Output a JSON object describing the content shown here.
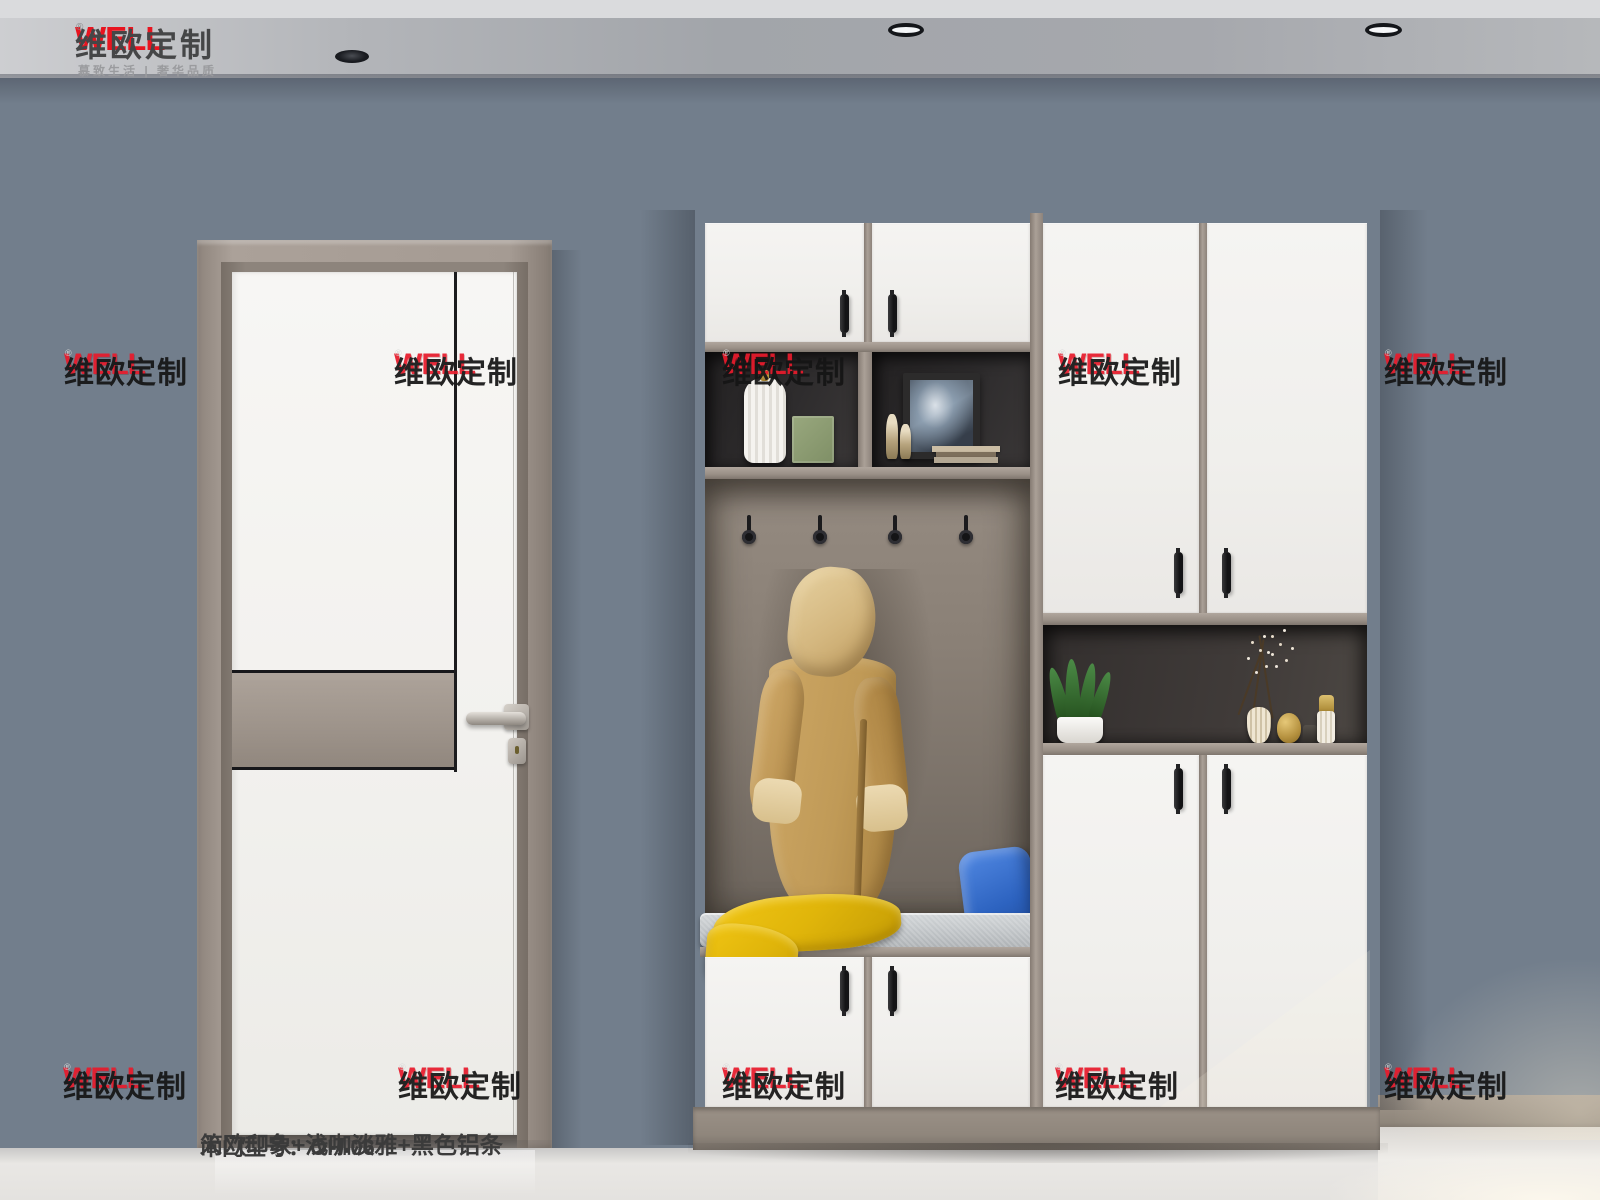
{
  "brand": {
    "name": "WELL",
    "reg": "®",
    "cn": "维欧定制",
    "tagline": "慕致生活 | 奢华品质"
  },
  "watermark": {
    "name": "WELL",
    "reg": "®",
    "cn": "维欧定制"
  },
  "caption": {
    "line1": "简欧印象+浅咖淡雅+黑色铝条",
    "line2": "木门型号：OH-06"
  },
  "palette": {
    "brand_red": "#e8141f",
    "wall_blue_gray": "#727e8c",
    "frame_taupe": "#9c9289",
    "door_white": "#f3f2f0",
    "shelf_dark": "#2e2c2d",
    "nook_back_taupe": "#847a70",
    "robe_camel": "#c49f63",
    "scarf_yellow": "#e3b70d",
    "pillow_blue": "#2f66c2",
    "cushion_gray": "#c6cacd",
    "floor_marble": "#e7e5e2",
    "aluminum_black": "#1c1c1e"
  }
}
